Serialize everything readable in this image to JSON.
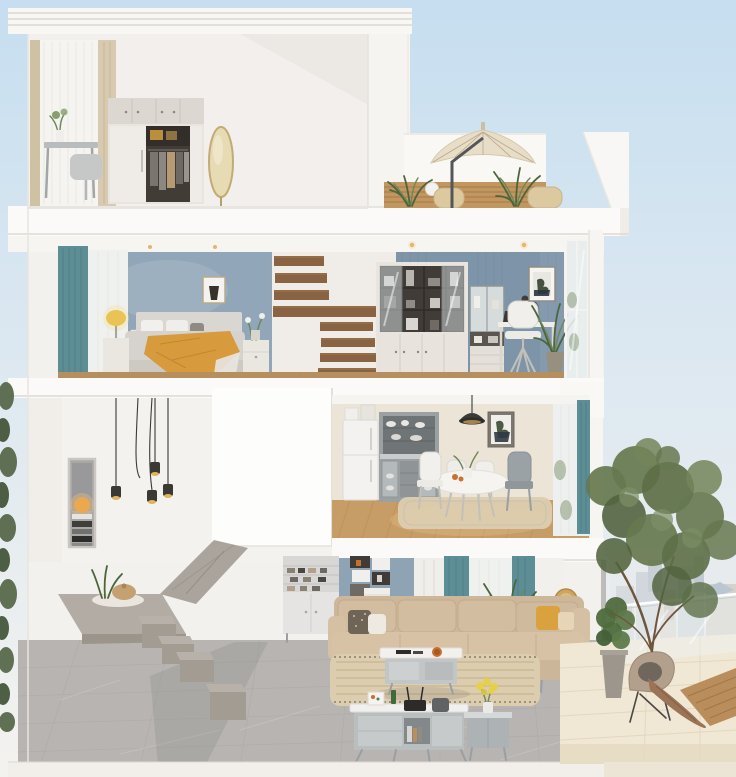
{
  "meta": {
    "type": "3d-cutaway-dollhouse-render",
    "subject": "three-storey townhouse cross-section",
    "width": 736,
    "height": 777
  },
  "palette": {
    "sky_top": "#c6def0",
    "sky_mid": "#dce8f1",
    "sky_bottom": "#f4f2ef",
    "wall_white": "#f5f3f0",
    "slab_white": "#fbfaf8",
    "bedroom_wall": "#91a6b9",
    "study_wall": "#7e95a9",
    "living_wall": "#8ea3b4",
    "kitchen_wall": "#ece4d6",
    "teal_curtain": "#5d8d95",
    "mustard_throw": "#d79a3c",
    "mustard_pillow": "#d9a23f",
    "wood_tread": "#8a6442",
    "wood_floor": "#c79d67",
    "wood_slat": "#c1965f",
    "deck_wood": "#b98e5c",
    "umbrella": "#e8ddc7",
    "sofa": "#d3bda1",
    "rug": "#dccdaf",
    "concrete": "#aaa49c",
    "step_concrete": "#b7b1a9",
    "tile_gray": "#b7b4b1",
    "tile_cream": "#f0e7d4",
    "tree_green": "#66784f",
    "plant_green": "#4f6b3d",
    "glass": "#e7eced",
    "city_haze": "#dfe4e8"
  },
  "floors": [
    {
      "id": "roof-terrace",
      "objects": [
        "cantilever-umbrella",
        "wood-slat-wall",
        "wicker-stools",
        "potted-ferns",
        "parapet-walls"
      ]
    },
    {
      "id": "top-floor-dressing-room",
      "objects": [
        "window-drapes",
        "vanity-desk",
        "vanity-chair",
        "wardrobe-open-closet",
        "oval-mirror",
        "flower-vase"
      ]
    },
    {
      "id": "second-floor",
      "rooms": [
        {
          "id": "master-bedroom",
          "objects": [
            "teal-curtain",
            "bed",
            "mustard-throw",
            "table-lamp",
            "nightstands",
            "wall-art",
            "light-switches"
          ]
        },
        {
          "id": "floating-stair-well",
          "objects": [
            "wood-treads-upper",
            "wood-beam",
            "wood-treads-lower"
          ]
        },
        {
          "id": "study",
          "objects": [
            "bookcase-display",
            "glass-cabinet",
            "desk",
            "laptop",
            "desk-lamp",
            "white-chair",
            "botanical-art",
            "potted-plant",
            "glass-partition"
          ]
        }
      ]
    },
    {
      "id": "first-floor",
      "rooms": [
        {
          "id": "double-height-void",
          "objects": [
            "pendant-light-cluster",
            "sunset-art"
          ]
        },
        {
          "id": "stair-enclosure-block",
          "objects": []
        },
        {
          "id": "dining-kitchen",
          "objects": [
            "fridge",
            "hutch-cabinet",
            "black-pendant-lamp",
            "round-dining-table",
            "dining-chairs",
            "area-rug",
            "botanical-art",
            "window-teal-curtain"
          ]
        }
      ]
    },
    {
      "id": "ground-floor",
      "rooms": [
        {
          "id": "entry-stair-hall",
          "objects": [
            "concrete-landing",
            "floating-concrete-steps",
            "aloe-plant",
            "straw-basket"
          ]
        },
        {
          "id": "living-room",
          "objects": [
            "shoe-cabinet",
            "wall-box-shelves",
            "teal-curtains",
            "palm-plant",
            "sectional-sofa",
            "throw-pillows",
            "coffee-table",
            "striped-rug",
            "tv-console",
            "router",
            "speaker",
            "flower-vase",
            "side-console",
            "gold-round-decor"
          ]
        },
        {
          "id": "patio",
          "objects": [
            "garden-tree",
            "fiddle-leaf-pot",
            "lounge-chair",
            "draped-throw",
            "glass-railing",
            "wood-deck-strip",
            "city-skyline"
          ]
        }
      ]
    }
  ]
}
